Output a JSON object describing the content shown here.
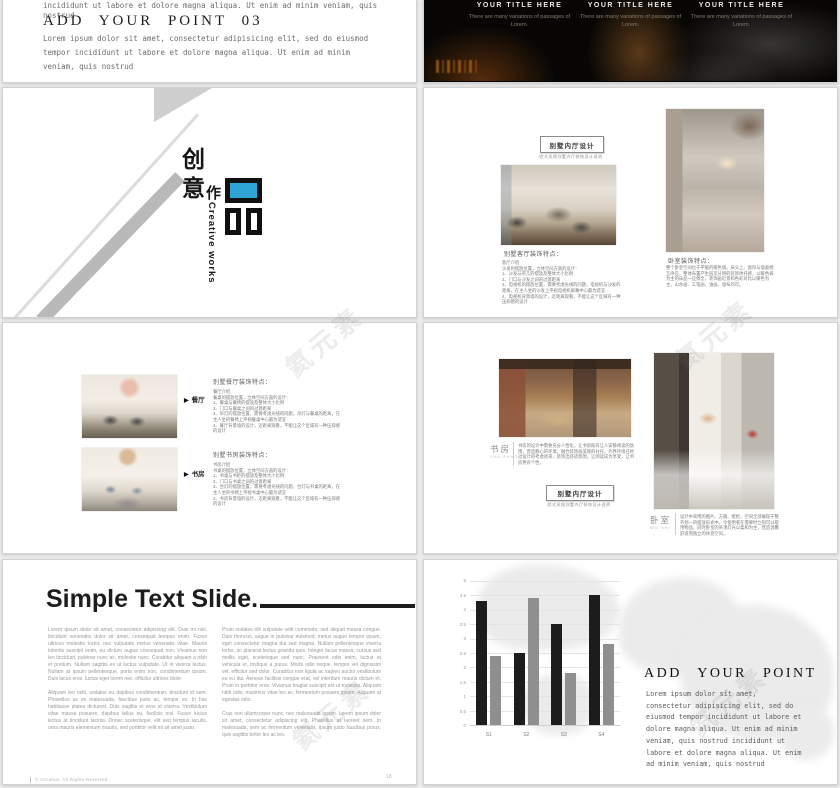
{
  "watermark": {
    "text": "氦元素"
  },
  "colors": {
    "accent_blue": "#2ea3d6",
    "bar_dark": "#1c1c1c",
    "bar_gray": "#8f8f8f"
  },
  "slide1_left": {
    "cut_line1": "incididunt ut labore et dolore magna aliqua. Ut enim ad minim veniam, quis",
    "cut_line2": "nostrud",
    "heading": "ADD  YOUR  POINT  03",
    "body": "Lorem ipsum dolor sit amet, consectetur adipisicing elit, sed do eiusmod tempor incididunt ut labore et dolore magna aliqua. Ut enim ad minim veniam, quis nostrud"
  },
  "slide1_right": {
    "columns": [
      {
        "title": "YOUR TITLE HERE",
        "body": "There are many variations of passages of Lorem."
      },
      {
        "title": "YOUR TITLE HERE",
        "body": "There are many variations of passages of Lorem."
      },
      {
        "title": "YOUR TITLE HERE",
        "body": "There are many variations of passages of Lorem."
      }
    ]
  },
  "slide2_left": {
    "cn_char1": "创",
    "cn_char2": "意",
    "cn_char3": "作",
    "pin_char": "品",
    "en_caption": "Creative works"
  },
  "slide2_right": {
    "title_box": "别墅内厅设计",
    "subtitle": "欧式风格别墅内厅装饰设计说明",
    "left_caption": "别墅客厅装饰特点：",
    "left_body": "客厅介绍\n沙发的摆放位置，立体空间方面的设计：\n1、沙发与茶几的摆放及整体大小比例\n2、门口与沙发之间的过渡距离\n3、电视机的摆放位置，需要考虑光线的问题，电视机与沙发的距离，在主人坐的沙发上平视电视机屏幕中心最为适宜\n4、电视机背景墙的设计，近距离观看，不能让这个区域有一种压抑感的设计",
    "right_caption": "卧室装饰特点：",
    "right_body": "整个卧室空间位于平缓的暖色调，床头上、窗帘与墙面相互呼应，整体布置产生层次分明的装饰烘托感，以暖色调为主的床品一应俱全，装饰画近景和色彩对比以暖色为主，山水画、工笔画、油画、墙布均可。"
  },
  "slide3_left": {
    "items": [
      {
        "tag": "餐厅",
        "heading": "别墅餐厅装饰特点：",
        "body": "餐厅介绍\n餐桌的摆放位置，立体空间方面的设计：\n1、餐桌与餐椅的摆放及整体大小比例\n2、门口与餐桌之间的过渡距离\n3、吊灯的摆放位置，需要考虑光线的问题，吊灯与餐桌的距离，在主人坐的餐椅上平视餐桌中心最为适宜\n4、餐厅背景墙的设计，近距离观看，不能让这个区域有一种压抑感的设计"
      },
      {
        "tag": "书房",
        "heading": "别墅书房装饰特点：",
        "body": "书房介绍\n书桌的摆放位置，立体空间方面的设计：\n1、书桌与书柜的摆放及整体大小比例\n2、门口与书桌之间的过渡距离\n3、台灯的摆放位置，需要考虑光线的问题，台灯与书桌的距离，在主人坐的书椅上平视书桌中心最为适宜\n4、书房背景墙的设计，近距离观看，不能让这个区域有一种压抑感的设计"
      }
    ]
  },
  "slide3_right": {
    "left_label_cn": "书房",
    "left_label_en": "SHU FANG",
    "left_body": "书房的设计中需要充分人性化，让书房既有让人安静阅读的氛围，营造静心的环境，融合装饰画美感的衬托。外界环境已经过设计的考虑进来，装饰出舒适氛围，让阅读成为享受，让书房更有个性。",
    "title_box": "别墅内厅设计",
    "subtitle": "欧式风格别墅内厅装饰设计说明",
    "right_label_cn": "卧室",
    "right_label_en": "WO SHI",
    "right_body": "设计中采用的图片、方圆、壁柜，空间全部展现于整齐划一的摆放形式中，令使用者在需要时立刻可以取用物品，同时卧室的吊顶灯光以柔和为主，营造温馨舒适而独立的休息空间。"
  },
  "slide4_left": {
    "title": "Simple Text Slide.",
    "col1": [
      "Lorem ipsum dolor sit amet, consectetur adipiscing elit. Duis mi nisl, tincidunt venenatis dolor sit amet, consequat tempus enim. Fusce ultrices molestie tortor, nec vulputate metus venenatis vitae. Mauris lobortis suscipit enim, eu dictum augue consequat non. Vivamus non leo tincidunt, pulvinar nunc ac, molestie nunc. Curabitur aliquam a nibh et pretium. Nullam sagittis ex ut luctus vulputate. Ut in viverra lectus. Nullam at ipsum pellentesque, porta enim non, condimentum ipsum. Duis lacus eros, luctus eget lorem nec, efficitur ultrices dolor.",
      "Aliquam leo velit, sodales eu dapibus condimentum, tincidunt id sem. Phasellus ac ex malesuada, faucibus justo ac, tempor ex. In hac habitasse platea dictumst. Duis sagittis et eros et viverra. Vestibulum vitae massa posuere, dapibus tellus eu, facilisis nisl. Fusce luctus lectus at tincidunt lacinia. Donec scelerisque, elit sed tempus iaculis, urna mauris elementum mauris, sed porttitor velit mi sit amet justo."
    ],
    "col2": [
      "Proin sodales elit vulputate velit commodo, sed aliquet massa congue. Duis rhoncus, augue in pulvinar euismod, metus augue tempor ipsum, eget consectetur magna dui sed magna. Nullam pellentesque viverra tortor, ac placerat lectus gravida quis. Integer lacus massa, cursus sed mollis eget, scelerisque sed nunc. Praesent odio enim, luctus et vehicula et, tristique a purus. Morbi odio neque, tempor vel dignissim vel, efficitur sed dolor. Curabitur non ligula ac sapien auctor vestibulum eu eu dui. Aenean facilisis congue erat, vel interdum mauris dictum et. Proin in porttitor eros. Vivamus feugiat suscipit est ut molestie. Aliquam nibh odio, maximus vitae leo ac, fermentum posuere ipsum. Aliquam at egestas odio.",
      "Cras non ullamcorper nunc, nec malesuada ipsum. Lorem ipsum dolor sit amet, consectetur adipiscing elit. Phasellus at laoreet sem. In malesuada, sem ac fermentum venenatis, ipsum justo faucibus purus, quis sagittis tortor leo ac leo."
    ],
    "footer": "© Vizuelus. All Rights Reserved",
    "page_number": "18"
  },
  "slide4_right": {
    "heading": "ADD  YOUR  POINT",
    "body": "Lorem ipsum dolor sit amet, consectetur adipisicing elit, sed do eiusmod tempor incididunt ut labore et dolore magna aliqua. Ut enim ad minim veniam, quis nostrud incididunt ut labore et dolore magna aliqua. Ut enim ad minim veniam, quis nostrud"
  },
  "chart_data": {
    "type": "bar",
    "categories": [
      "S1",
      "S2",
      "S3",
      "S4"
    ],
    "series": [
      {
        "name": "series1",
        "color": "#1c1c1c",
        "values": [
          4.3,
          2.5,
          3.5,
          4.5
        ]
      },
      {
        "name": "series2",
        "color": "#8f8f8f",
        "values": [
          2.4,
          4.4,
          1.8,
          2.8
        ]
      }
    ],
    "title": "",
    "xlabel": "",
    "ylabel": "",
    "ylim": [
      0,
      5
    ],
    "ytick_step": 0.5,
    "grid": true,
    "legend": "none"
  }
}
